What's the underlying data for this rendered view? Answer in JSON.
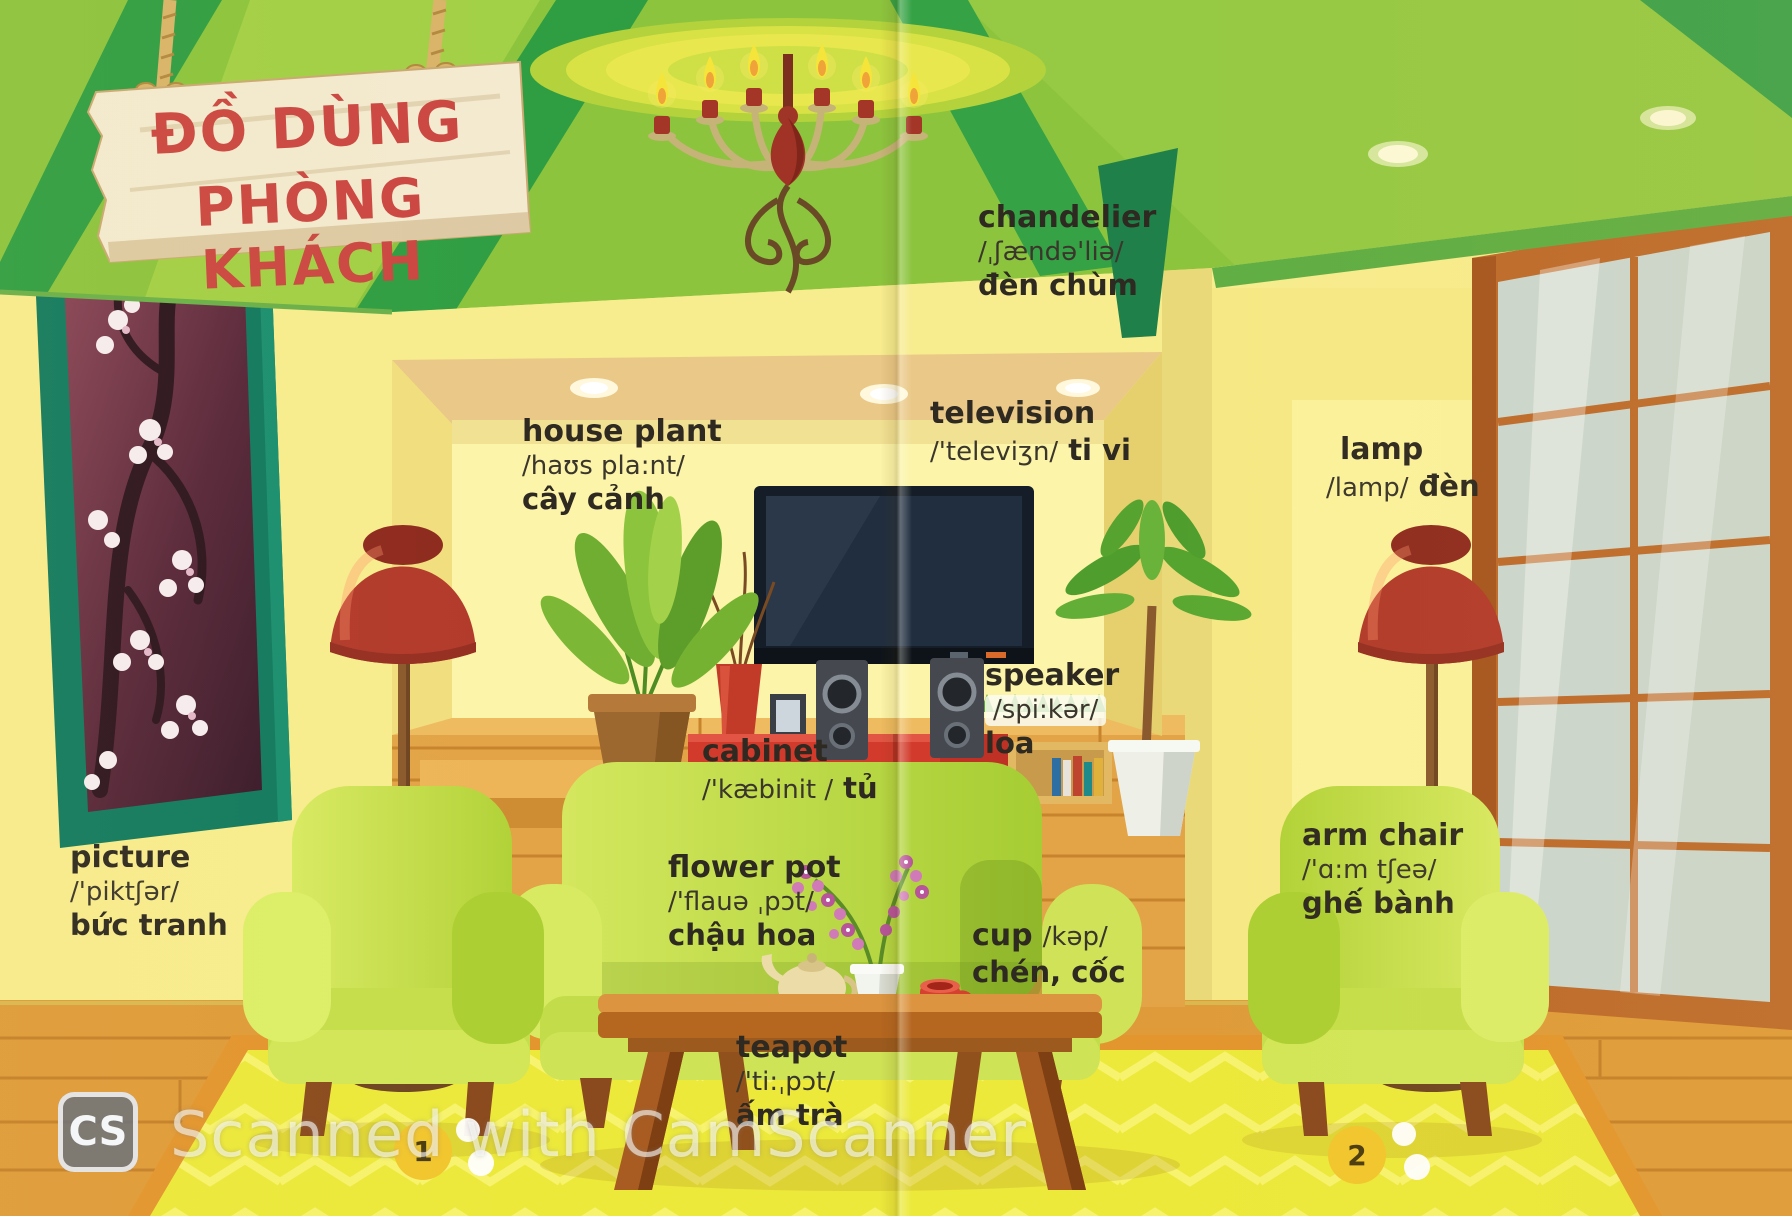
{
  "sign": {
    "line1": "ĐỒ DÙNG",
    "line2": "PHÒNG KHÁCH"
  },
  "pages": {
    "left_number": "1",
    "right_number": "2"
  },
  "watermark": {
    "logo": "CS",
    "text": "Scanned with CamScanner"
  },
  "labels": {
    "chandelier": {
      "word": "chandelier",
      "phonetic": "/ˌʃændə'liə/",
      "viet": "đèn chùm"
    },
    "house_plant": {
      "word": "house plant",
      "phonetic": "/haʊs pla:nt/",
      "viet": "cây cảnh"
    },
    "television": {
      "word": "television",
      "phonetic": "/'televiʒn/",
      "viet": "ti vi"
    },
    "lamp": {
      "word": "lamp",
      "phonetic": "/lamp/",
      "viet": "đèn"
    },
    "speaker": {
      "word": "speaker",
      "phonetic": "/spi:kər/",
      "viet": "loa"
    },
    "cabinet": {
      "word": "cabinet",
      "phonetic": "/'kæbinit /",
      "viet": "tủ"
    },
    "picture": {
      "word": "picture",
      "phonetic": "/'piktʃər/",
      "viet": "bức tranh"
    },
    "flower_pot": {
      "word": "flower pot",
      "phonetic": "/'flauə ˌpɔt/",
      "viet": "chậu hoa"
    },
    "cup": {
      "word": "cup",
      "phonetic": "/kəp/",
      "viet": "chén, cốc"
    },
    "teapot": {
      "word": "teapot",
      "phonetic": "/'ti:ˌpɔt/",
      "viet": "ấm trà"
    },
    "arm_chair": {
      "word": "arm chair",
      "phonetic": "/'ɑ:m tʃeə/",
      "viet": "ghế bành"
    }
  },
  "colors": {
    "ceiling_green": "#8cc43e",
    "wall_yellow": "#f7ec8e",
    "cabinet_red": "#d23a2c",
    "sofa_green": "#bcd83e",
    "rug_yellow": "#ece93b",
    "title_red": "#cb4742"
  }
}
